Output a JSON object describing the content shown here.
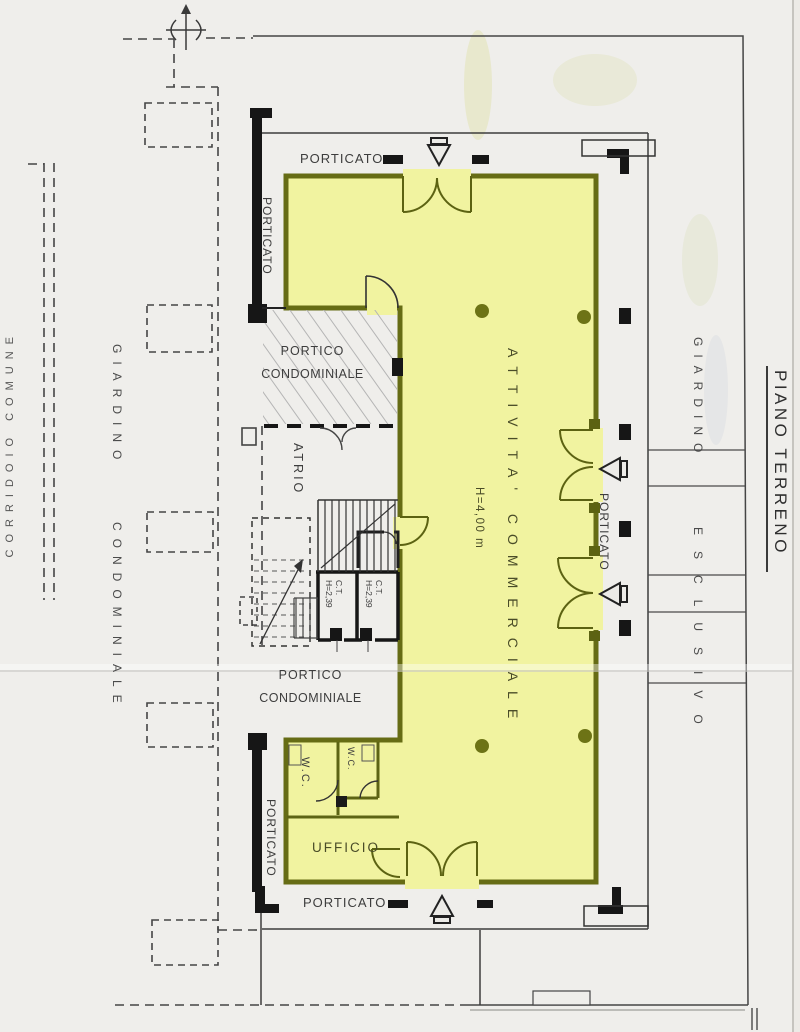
{
  "document": {
    "type": "scanned architectural floor plan",
    "floor_title": "PIANO TERRENO"
  },
  "labels": {
    "porticato": "PORTICATO",
    "portico_condominiale": [
      "PORTICO",
      "CONDOMINIALE"
    ],
    "atrio": "ATRIO",
    "attivita_commerciale": "ATTIVITA' COMMERCIALE",
    "altezza_locale": "H=4,00 m",
    "ct": "C.T.",
    "ct_altezza": "H=2,39",
    "wc": "W.C.",
    "ufficio": "UFFICIO",
    "giardino_condominiale": [
      "GIARDINO",
      "CONDOMINIALE"
    ],
    "giardino_esclusivo": [
      "GIARDINO",
      "ESCLUSIVO"
    ],
    "piano_terreno": "PIANO TERRENO",
    "corridoio_comune": "CORRIDOIO COMUNE"
  },
  "colors": {
    "paper": "#efeeeb",
    "highlight_yellow": "#f1f3a0",
    "wall_olive": "#666c15",
    "ink": "#3d3d3d"
  }
}
